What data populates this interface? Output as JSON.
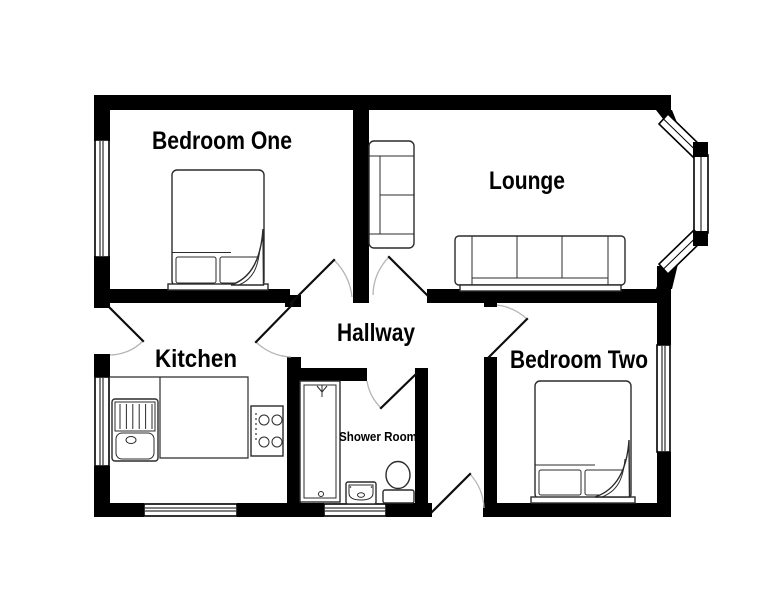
{
  "floorplan": {
    "rooms": {
      "bedroom_one": {
        "label": "Bedroom One"
      },
      "lounge": {
        "label": "Lounge"
      },
      "hallway": {
        "label": "Hallway"
      },
      "kitchen": {
        "label": "Kitchen"
      },
      "shower_room": {
        "label": "Shower Room"
      },
      "bedroom_two": {
        "label": "Bedroom Two"
      }
    },
    "colors": {
      "wall": "#000000",
      "floor": "#ffffff",
      "fixture_line": "#2b2b2b",
      "door_arc": "#b5b5b5"
    }
  }
}
